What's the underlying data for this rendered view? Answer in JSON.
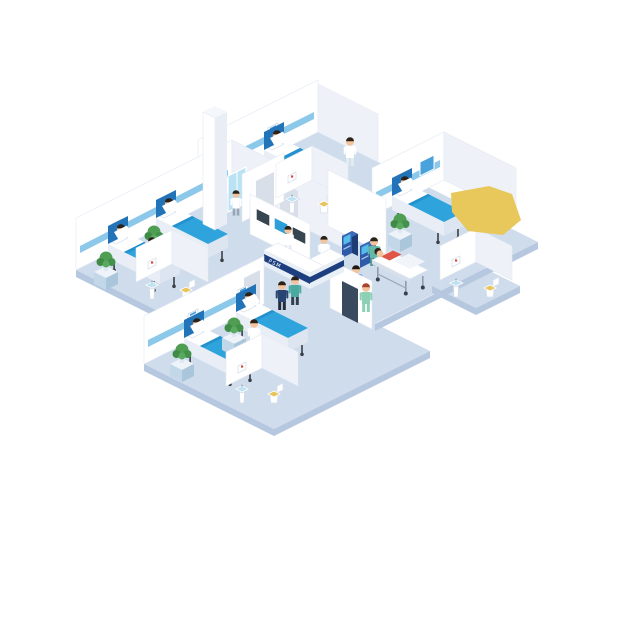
{
  "scene": {
    "description": "Isometric hospital ward cutaway illustration: patient rooms with beds, bathrooms, nurse reception desk, wall monitors, self-service kiosks, elevator core, stretcher with patient, doctors, nurses and visitors",
    "reception": {
      "desk_sign": "PSM"
    },
    "colors": {
      "floor": "#cfdcec",
      "floor_side": "#b6c7e0",
      "wall": "#ffffff",
      "wall_side": "#eef2f8",
      "wall_edge": "#e3e9f1",
      "rail": "#8cc8ea",
      "blanket": "#2fa3dc",
      "blanket_fold": "#2490cc",
      "headboard": "#2273b8",
      "bedside": "#e9eef6",
      "desk_navy": "#1e3f7f",
      "desk_body": "#e9eff7",
      "screen_dark": "#36454f",
      "screen_blue": "#2f9fd9",
      "kiosk_blue": "#2f5aa8",
      "kiosk_screen": "#56bdea",
      "plant": "#4f9e53",
      "skin": "#f2c49e",
      "hair": "#2c2218",
      "door": "#d9dfe8",
      "door_dark": "#3a4a5e",
      "glass": "#b9e2f4",
      "toilet_seat": "#e7c45c",
      "yellow": "#e8c85a",
      "patient_red": "#df5548",
      "scrub_teal": "#63b8a9",
      "scrub_green": "#8ed0b5",
      "hair_red": "#a8432e"
    },
    "bed_signs": [
      {
        "x": 222,
        "y": 152,
        "layer": "deco-a"
      },
      {
        "x": 268,
        "y": 128,
        "layer": "deco-a"
      },
      {
        "x": 112,
        "y": 224,
        "layer": "deco-b"
      },
      {
        "x": 160,
        "y": 200,
        "layer": "deco-b"
      },
      {
        "x": 188,
        "y": 314,
        "layer": "deco-c"
      },
      {
        "x": 238,
        "y": 290,
        "layer": "deco-c"
      },
      {
        "x": 396,
        "y": 178,
        "layer": "deco-d"
      }
    ],
    "frames": [
      {
        "x": 288,
        "y": 176,
        "layer": "bath-a"
      },
      {
        "x": 148,
        "y": 262,
        "layer": "bath-b"
      },
      {
        "x": 238,
        "y": 366,
        "layer": "bath-c"
      },
      {
        "x": 452,
        "y": 260,
        "layer": "bath-d"
      }
    ],
    "beds": [
      {
        "name": "bed-room-a-1",
        "x": 216,
        "y": 188,
        "layer": "items-a"
      },
      {
        "name": "bed-room-a-2",
        "x": 264,
        "y": 164,
        "layer": "items-a"
      },
      {
        "name": "bed-room-b-1",
        "x": 108,
        "y": 258,
        "layer": "items-b"
      },
      {
        "name": "bed-room-b-2",
        "x": 156,
        "y": 232,
        "layer": "items-b"
      },
      {
        "name": "bed-room-c-1",
        "x": 184,
        "y": 352,
        "layer": "items-c"
      },
      {
        "name": "bed-room-c-2",
        "x": 236,
        "y": 326,
        "layer": "items-c"
      },
      {
        "name": "bed-room-d",
        "x": 392,
        "y": 210,
        "layer": "items-d"
      }
    ],
    "plants": [
      {
        "x": 246,
        "y": 182,
        "layer": "items-a"
      },
      {
        "x": 94,
        "y": 266,
        "layer": "items-b"
      },
      {
        "x": 142,
        "y": 240,
        "layer": "items-b"
      },
      {
        "x": 170,
        "y": 358,
        "layer": "items-c"
      },
      {
        "x": 222,
        "y": 332,
        "layer": "items-c"
      },
      {
        "x": 388,
        "y": 228,
        "layer": "items-d"
      }
    ],
    "sinks": [
      {
        "x": 292,
        "y": 202,
        "layer": "bath-a"
      },
      {
        "x": 152,
        "y": 288,
        "layer": "bath-b"
      },
      {
        "x": 242,
        "y": 392,
        "layer": "bath-c"
      },
      {
        "x": 456,
        "y": 286,
        "layer": "bath-d"
      }
    ],
    "toilets": [
      {
        "x": 324,
        "y": 206,
        "layer": "bath-a"
      },
      {
        "x": 186,
        "y": 292,
        "layer": "bath-b"
      },
      {
        "x": 274,
        "y": 396,
        "layer": "bath-c"
      },
      {
        "x": 490,
        "y": 290,
        "layer": "bath-d"
      }
    ],
    "kiosks": [
      {
        "x": 342,
        "y": 258,
        "layer": "kiosks"
      },
      {
        "x": 360,
        "y": 268,
        "layer": "kiosks"
      }
    ],
    "people": [
      {
        "name": "nurse-room-a",
        "x": 350,
        "y": 146,
        "layer": "items-a",
        "top": "#ffffff",
        "pants": "#e4ebf3",
        "hair": "#2c2218"
      },
      {
        "name": "nurse-room-b",
        "x": 152,
        "y": 246,
        "layer": "items-b",
        "top": "#ffffff",
        "pants": "#e4ebf3",
        "hair": "#2c2218"
      },
      {
        "name": "nurse-room-c",
        "x": 254,
        "y": 328,
        "layer": "items-c",
        "top": "#ffffff",
        "pants": "#e4ebf3",
        "hair": "#2c2218"
      },
      {
        "name": "nurse-room-d",
        "x": 504,
        "y": 206,
        "scale": 0.92,
        "layer": "items-d",
        "top": "#ffffff",
        "pants": "#e4ebf3",
        "hair": "#2c2218"
      },
      {
        "name": "elevator-visitor",
        "x": 236,
        "y": 198,
        "scale": 0.88,
        "layer": "center-back",
        "top": "#ffffff",
        "pants": "#98a7b8",
        "hair": "#2c2218"
      },
      {
        "name": "receptionist",
        "x": 288,
        "y": 234,
        "scale": 0.92,
        "layer": "center-mid",
        "top": "#ffffff",
        "pants": "#e4ebf3",
        "hair": "#2c2218"
      },
      {
        "name": "kiosk-user-coat",
        "x": 324,
        "y": 244,
        "scale": 0.92,
        "layer": "kiosk-people",
        "top": "#ffffff",
        "pants": "#6b7a8c",
        "hair": "#2c2218"
      },
      {
        "name": "kiosk-user-orange",
        "x": 338,
        "y": 264,
        "layer": "kiosk-people",
        "top": "#e0813f",
        "pants": "#3c4a5c",
        "hair": "#2c2218"
      },
      {
        "name": "kiosk-user-blue",
        "x": 356,
        "y": 274,
        "layer": "kiosk-people",
        "top": "#4180cf",
        "pants": "#2e3a4a",
        "hair": "#1f1812"
      },
      {
        "name": "stretcher-nurse",
        "x": 374,
        "y": 246,
        "layer": "stretcher-back",
        "top": "#63b8a9",
        "pants": "#4f9e8f",
        "hair": "#2c2218"
      },
      {
        "name": "visitor-navy",
        "x": 282,
        "y": 290,
        "layer": "corridor-front",
        "top": "#2a4472",
        "pants": "#222c3a",
        "hair": "#2c2218"
      },
      {
        "name": "visitor-teal",
        "x": 295,
        "y": 285,
        "layer": "corridor-front",
        "top": "#4aa9a0",
        "pants": "#32404e",
        "hair": "#2c2218"
      },
      {
        "name": "walking-nurse-green",
        "x": 366,
        "y": 292,
        "layer": "corridor-front",
        "top": "#8ed0b5",
        "pants": "#8ed0b5",
        "hair": "#a8432e"
      }
    ]
  }
}
